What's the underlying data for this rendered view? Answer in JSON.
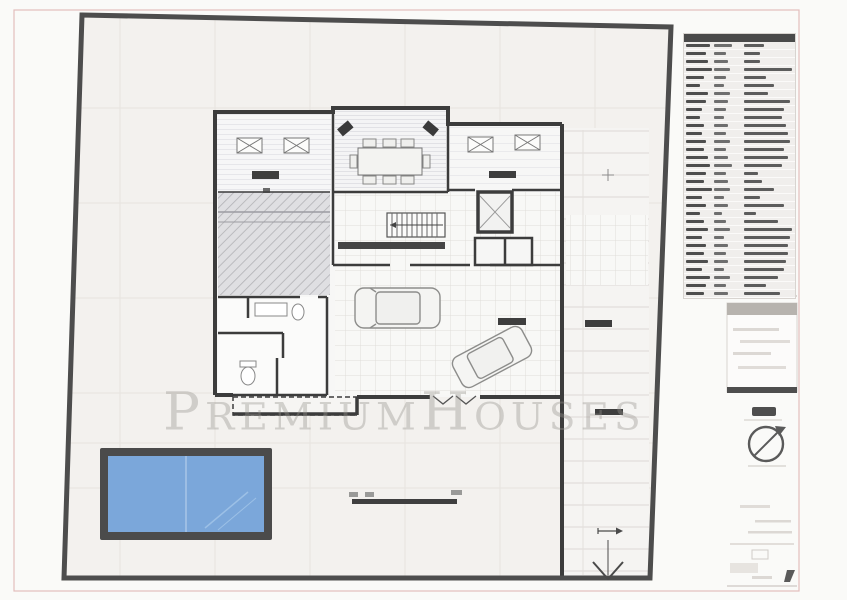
{
  "sheet": {
    "paper_color": "#fafaf8",
    "frame_color": "#e3bdbd"
  },
  "watermark": {
    "text": "PremiumHouses",
    "color": "rgba(150,147,143,0.38)"
  },
  "colors": {
    "site_boundary": "#4d4d4d",
    "building_wall": "#3c3c3c",
    "pool_water": "#7ba7da",
    "pool_edge": "#4b4b4b",
    "yard_fill": "#f3f1ee",
    "legend_header": "#4a4a4a"
  },
  "icons": {
    "compass": "north-arrow-icon",
    "driveway_arrow": "entry-arrow-icon"
  },
  "legend": {
    "description": "illegible room/surface schedule table",
    "rows": [
      [
        24,
        18,
        20
      ],
      [
        20,
        12,
        16
      ],
      [
        22,
        14,
        16
      ],
      [
        26,
        16,
        48
      ],
      [
        18,
        12,
        22
      ],
      [
        14,
        10,
        30
      ],
      [
        22,
        16,
        24
      ],
      [
        20,
        14,
        46
      ],
      [
        16,
        12,
        40
      ],
      [
        14,
        10,
        38
      ],
      [
        18,
        14,
        42
      ],
      [
        16,
        12,
        44
      ],
      [
        20,
        16,
        46
      ],
      [
        18,
        12,
        40
      ],
      [
        22,
        14,
        44
      ],
      [
        24,
        18,
        38
      ],
      [
        20,
        12,
        14
      ],
      [
        18,
        14,
        18
      ],
      [
        26,
        16,
        30
      ],
      [
        16,
        10,
        16
      ],
      [
        20,
        14,
        40
      ],
      [
        14,
        8,
        12
      ],
      [
        18,
        12,
        34
      ],
      [
        22,
        16,
        48
      ],
      [
        16,
        10,
        46
      ],
      [
        20,
        14,
        44
      ],
      [
        18,
        12,
        44
      ],
      [
        22,
        14,
        42
      ],
      [
        16,
        10,
        40
      ],
      [
        24,
        16,
        34
      ],
      [
        20,
        12,
        22
      ],
      [
        18,
        14,
        36
      ]
    ]
  }
}
